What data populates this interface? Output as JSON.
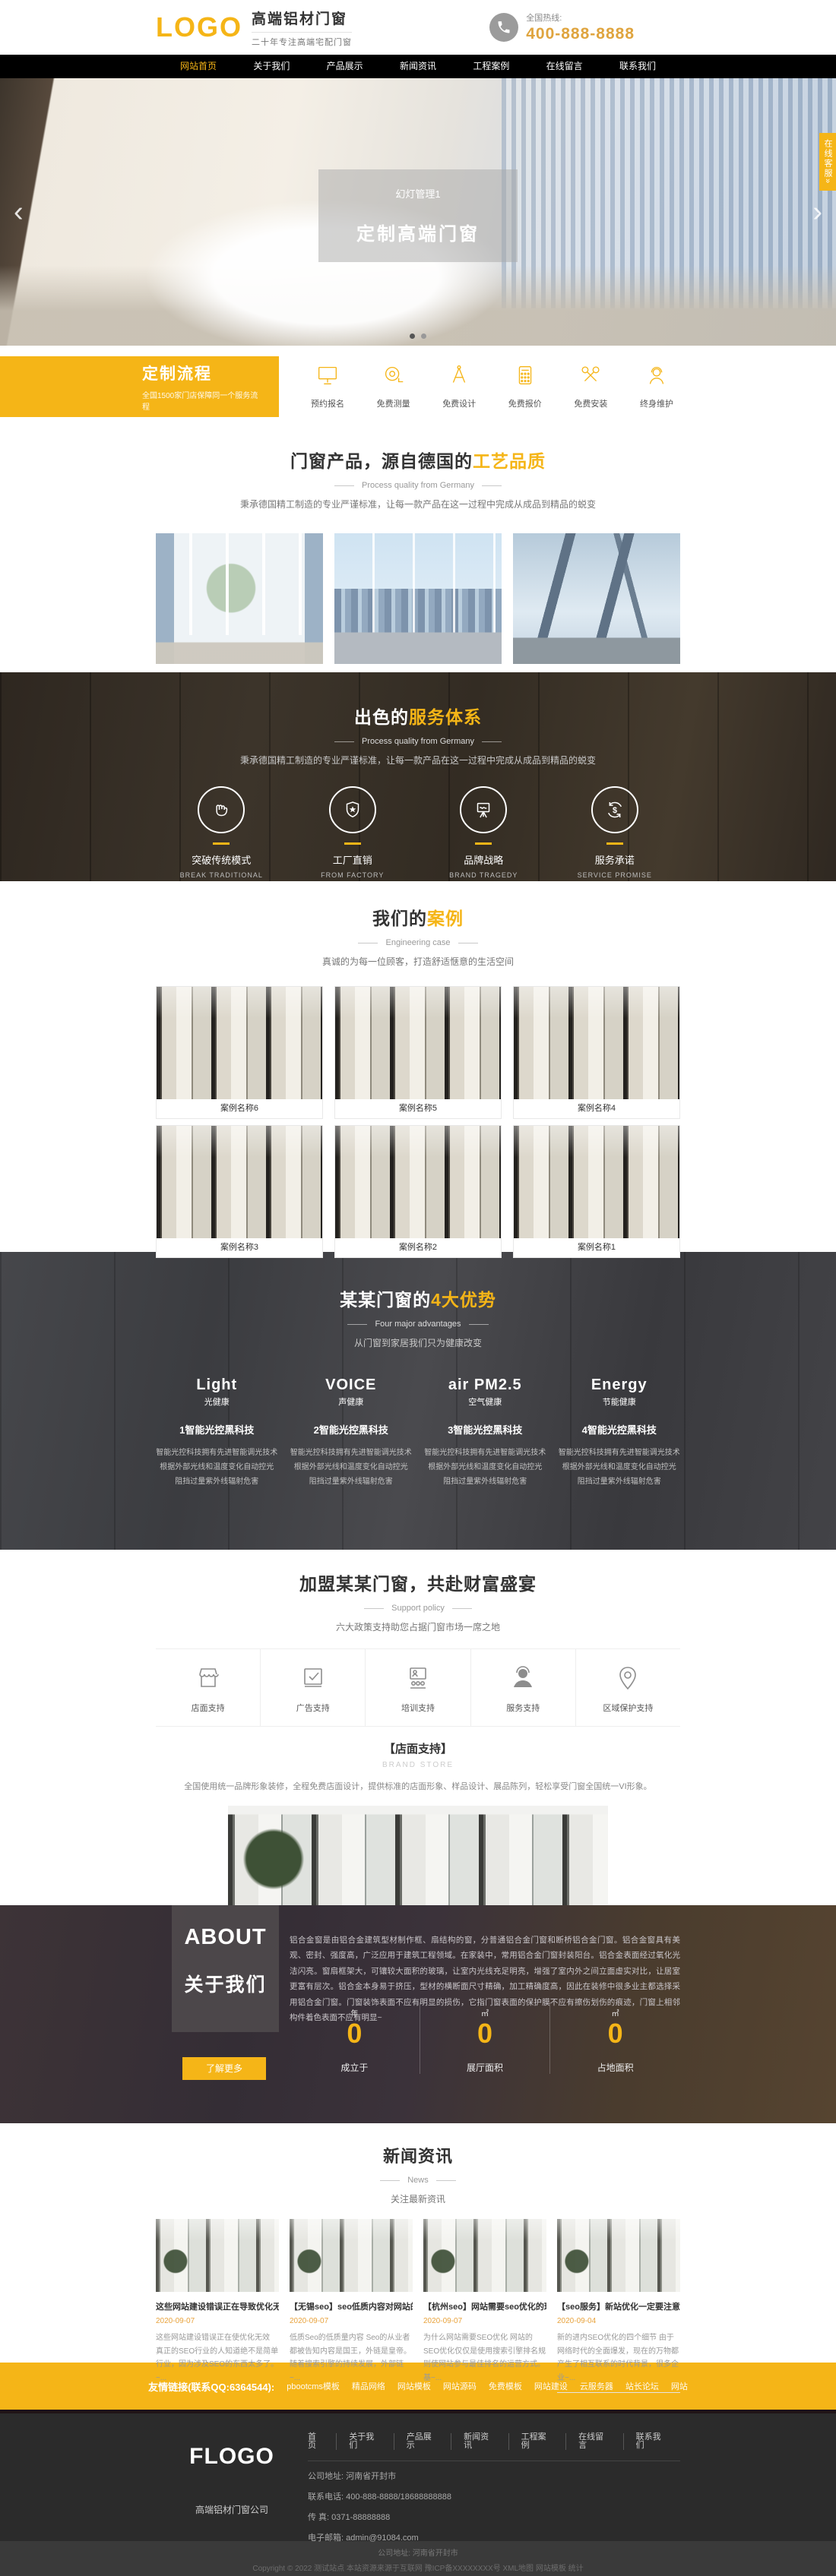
{
  "colors": {
    "brand_yellow": "#f5b517",
    "phone_gold": "#dfa43e"
  },
  "header": {
    "logo": "LOGO",
    "title": "高端铝材门窗",
    "subtitle": "二十年专注高端宅配门窗",
    "hotline_label": "全国热线:",
    "phone": "400-888-8888"
  },
  "nav": {
    "items": [
      {
        "label": "网站首页"
      },
      {
        "label": "关于我们"
      },
      {
        "label": "产品展示"
      },
      {
        "label": "新闻资讯"
      },
      {
        "label": "工程案例"
      },
      {
        "label": "在线留言"
      },
      {
        "label": "联系我们"
      }
    ]
  },
  "banner": {
    "slide_label": "幻灯管理1",
    "slide_title": "定制高端门窗",
    "prev": "‹",
    "next": "›",
    "service_tab": "在线客服»"
  },
  "process": {
    "title": "定制流程",
    "subtitle": "全国1500家门店保障同一个服务流程",
    "steps": [
      {
        "label": "预约报名"
      },
      {
        "label": "免费测量"
      },
      {
        "label": "免费设计"
      },
      {
        "label": "免费报价"
      },
      {
        "label": "免费安装"
      },
      {
        "label": "终身维护"
      }
    ]
  },
  "products": {
    "title_main": "门窗产品，源自德国的",
    "title_accent": "工艺品质",
    "subtitle": "Process quality from Germany",
    "desc": "秉承德国精工制造的专业严谨标准，让每一款产品在这一过程中完成从成品到精品的蜕变"
  },
  "services": {
    "title_main": "出色的",
    "title_accent": "服务体系",
    "subtitle": "Process quality from Germany",
    "desc": "秉承德国精工制造的专业严谨标准，让每一款产品在这一过程中完成从成品到精品的蜕变",
    "items": [
      {
        "zh": "突破传统模式",
        "en": "BREAK TRADITIONAL"
      },
      {
        "zh": "工厂直销",
        "en": "FROM FACTORY"
      },
      {
        "zh": "品牌战略",
        "en": "BRAND TRAGEDY"
      },
      {
        "zh": "服务承诺",
        "en": "SERVICE PROMISE"
      }
    ]
  },
  "cases": {
    "title_main": "我们的",
    "title_accent": "案例",
    "subtitle": "Engineering case",
    "desc": "真诚的为每一位顾客，打造舒适惬意的生活空间",
    "items": [
      {
        "label": "案例名称6"
      },
      {
        "label": "案例名称5"
      },
      {
        "label": "案例名称4"
      },
      {
        "label": "案例名称3"
      },
      {
        "label": "案例名称2"
      },
      {
        "label": "案例名称1"
      }
    ]
  },
  "advantages": {
    "title_main": "某某门窗的",
    "title_accent": "4大优势",
    "subtitle": "Four major advantages",
    "desc": "从门窗到家居我们只为健康改变",
    "items": [
      {
        "brand_en": "Light",
        "brand_zh": "光健康",
        "title": "1智能光控黑科技",
        "line1": "智能光控科技拥有先进智能调光技术",
        "line2": "根据外部光线和温度变化自动控光",
        "line3": "阻挡过量紫外线辐射危害"
      },
      {
        "brand_en": "VOICE",
        "brand_zh": "声健康",
        "title": "2智能光控黑科技",
        "line1": "智能光控科技拥有先进智能调光技术",
        "line2": "根据外部光线和温度变化自动控光",
        "line3": "阻挡过量紫外线辐射危害"
      },
      {
        "brand_en": "air PM2.5",
        "brand_zh": "空气健康",
        "title": "3智能光控黑科技",
        "line1": "智能光控科技拥有先进智能调光技术",
        "line2": "根据外部光线和温度变化自动控光",
        "line3": "阻挡过量紫外线辐射危害"
      },
      {
        "brand_en": "Energy",
        "brand_zh": "节能健康",
        "title": "4智能光控黑科技",
        "line1": "智能光控科技拥有先进智能调光技术",
        "line2": "根据外部光线和温度变化自动控光",
        "line3": "阻挡过量紫外线辐射危害"
      }
    ]
  },
  "join": {
    "title": "加盟某某门窗，共赴财富盛宴",
    "subtitle": "Support policy",
    "desc": "六大政策支持助您占据门窗市场一席之地",
    "tabs": [
      {
        "label": "店面支持"
      },
      {
        "label": "广告支持"
      },
      {
        "label": "培训支持"
      },
      {
        "label": "服务支持"
      },
      {
        "label": "区域保护支持"
      }
    ],
    "detail_title": "【店面支持】",
    "detail_en": "BRAND STORE",
    "detail_desc": "全国使用统一品牌形象装修，全程免费店面设计，提供标准的店面形象、样品设计、展品陈列，轻松享受门窗全国统一VI形象。"
  },
  "about": {
    "en": "ABOUT",
    "zh": "关于我们",
    "paragraph": "铝合金窗是由铝合金建筑型材制作框、扇结构的窗，分普通铝合金门窗和断桥铝合金门窗。铝合金窗具有美观、密封、强度高，广泛应用于建筑工程领域。在家装中，常用铝合金门窗封装阳台。铝合金表面经过氧化光洁闪亮。窗扇框架大，可镶较大面积的玻璃，让室内光线充足明亮，增强了室内外之间立面虚实对比，让居室更富有层次。铝合金本身易于挤压，型材的横断面尺寸精确，加工精确度高，因此在装修中很多业主都选择采用铝合金门窗。门窗装饰表面不应有明显的损伤，它指门窗表面的保护膜不应有擦伤划伤的痕迹，门窗上相邻构件着色表面不应有明显~",
    "more": "了解更多",
    "stats": [
      {
        "unit": "年",
        "value": "0",
        "label": "成立于"
      },
      {
        "unit": "㎡",
        "value": "0",
        "label": "展厅面积"
      },
      {
        "unit": "㎡",
        "value": "0",
        "label": "占地面积"
      }
    ]
  },
  "news": {
    "title": "新闻资讯",
    "subtitle": "News",
    "desc": "关注最新资讯",
    "items": [
      {
        "title": "这些网站建设错误正在导致优化无效",
        "date": "2020-09-07",
        "excerpt": "这些网站建设错误正在使优化无效 真正的SEO行业的人知道绝不是简单行业，因为涉及SEO的东西太多了。~..."
      },
      {
        "title": "【无锡seo】seo低质内容对网站的影响",
        "date": "2020-09-07",
        "excerpt": "低质Seo的低质量内容 Seo的从业者都被告知内容是国王，外链是皇帝。随着搜索引擎的持续发展，外部链~..."
      },
      {
        "title": "【杭州seo】网站需要seo优化的理由",
        "date": "2020-09-07",
        "excerpt": "为什么网站需要SEO优化 网站的SEO优化仅仅是使用搜索引擎排名规则使网站参与最佳排名的运营方式。基~..."
      },
      {
        "title": "【seo服务】新站优化一定要注意这些细",
        "date": "2020-09-04",
        "excerpt": "新的进内SEO优化的四个细节 由于网络时代的全面爆发，现在的万物都产生了相互联系的时代背景，很多企业~..."
      }
    ]
  },
  "links_bar": {
    "label": "友情链接(联系QQ:6364544):",
    "links": [
      {
        "label": "pbootcms模板"
      },
      {
        "label": "精品网络"
      },
      {
        "label": "网站模板"
      },
      {
        "label": "网站源码"
      },
      {
        "label": "免费模板"
      },
      {
        "label": "网站建设"
      },
      {
        "label": "云服务器"
      },
      {
        "label": "站长论坛"
      },
      {
        "label": "网站"
      }
    ]
  },
  "footer": {
    "nav": [
      {
        "label": "首页"
      },
      {
        "label": "关于我们"
      },
      {
        "label": "产品展示"
      },
      {
        "label": "新闻资讯"
      },
      {
        "label": "工程案例"
      },
      {
        "label": "在线留言"
      },
      {
        "label": "联系我们"
      }
    ],
    "logo": "FLOGO",
    "company": "高端铝材门窗公司",
    "address": "公司地址: 河南省开封市",
    "tel": "联系电话: 400-888-8888/18688888888",
    "fax": "传 真: 0371-88888888",
    "email": "电子邮箱: admin@91084.com",
    "bottom_address": "公司地址: 河南省开封市",
    "copyright": "Copyright © 2022 测试站点 本站资源来源于互联网 豫ICP备XXXXXXXX号 XML地图 网站模板 统计"
  }
}
